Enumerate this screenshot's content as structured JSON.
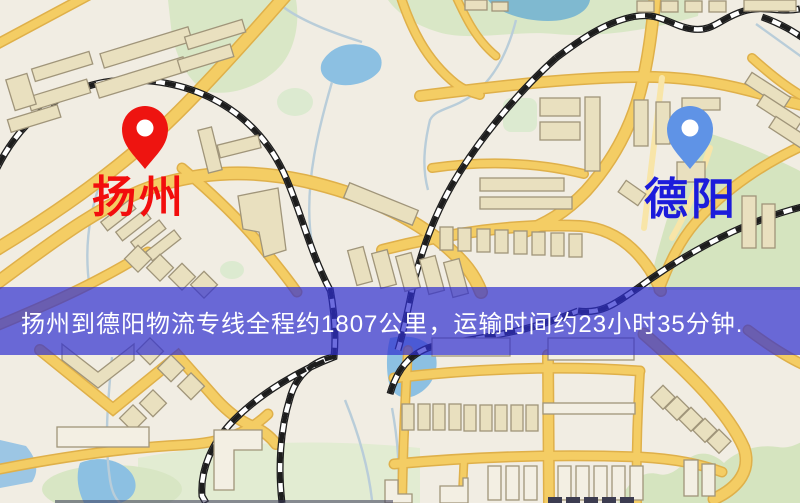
{
  "window": {
    "width": 800,
    "height": 503
  },
  "map": {
    "type": "route-map",
    "markers": [
      {
        "id": "yangzhou",
        "label": "扬州",
        "pin_color": "#ee1410",
        "label_color": "#f20d0d",
        "pin_style": "map-pin"
      },
      {
        "id": "deyang",
        "label": "德阳",
        "pin_color": "#5f93e6",
        "label_color": "#1c1cdb",
        "pin_style": "map-pin"
      }
    ],
    "banner": {
      "text": "扬州到德阳物流专线全程约1807公里，运输时间约23小时35分钟.",
      "background": "#2f2fd0",
      "background_opacity": 0.7,
      "text_color": "#ffffff"
    },
    "route": {
      "from": "扬州",
      "to": "德阳",
      "distance_km": "1807",
      "duration": "23小时35分钟"
    },
    "palette": {
      "map_background": "#f1ede3",
      "road_fill": "#f4cd64",
      "road_casing": "#dfb04a",
      "park_green": "#d9e7c6",
      "water_blue": "#8cc0e2",
      "building_fill": "#e9e0bf",
      "building_outline": "#a0957a",
      "railway": "#1d1d1d"
    }
  }
}
